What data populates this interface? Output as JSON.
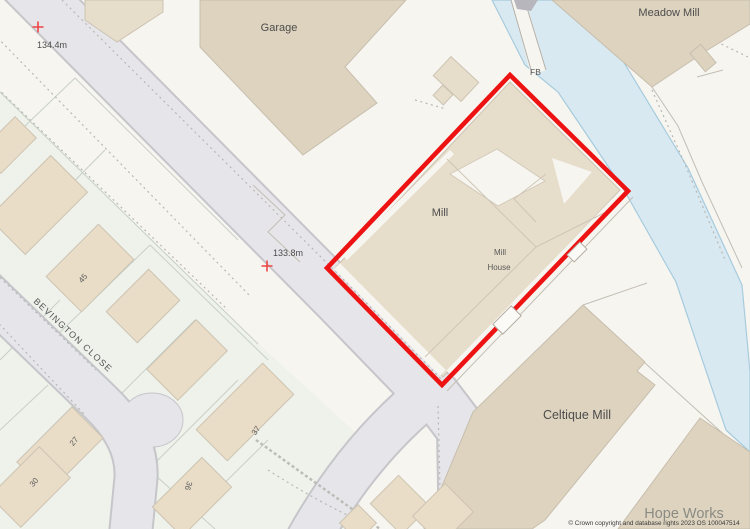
{
  "map": {
    "labels": {
      "garage": "Garage",
      "meadow_mill": "Meadow Mill",
      "fb": "FB",
      "mill": "Mill",
      "mill_house_line1": "Mill",
      "mill_house_line2": "House",
      "celtique_mill": "Celtique Mill",
      "hope_works": "Hope Works",
      "street": "BEVINGTON CLOSE"
    },
    "heights": {
      "h1": "134.4m",
      "h2": "133.8m"
    },
    "house_numbers": {
      "n45": "45",
      "n27": "27",
      "n30": "30",
      "n36": "36",
      "n37": "37"
    },
    "attribution": "© Crown copyright and database rights 2023 OS 100047514",
    "colors": {
      "boundary_red": "#ed1313",
      "building_beige": "#ddd3bf",
      "building_light": "#e6ddca",
      "river_blue": "#d9e9f2",
      "river_edge": "#a6cbdd",
      "road_gray": "#e6e5ea",
      "road_casing": "#c6c5ca",
      "parcel_green": "#eef2eb",
      "background": "#f7f5f0",
      "spot_height_red": "#ef4444"
    }
  }
}
